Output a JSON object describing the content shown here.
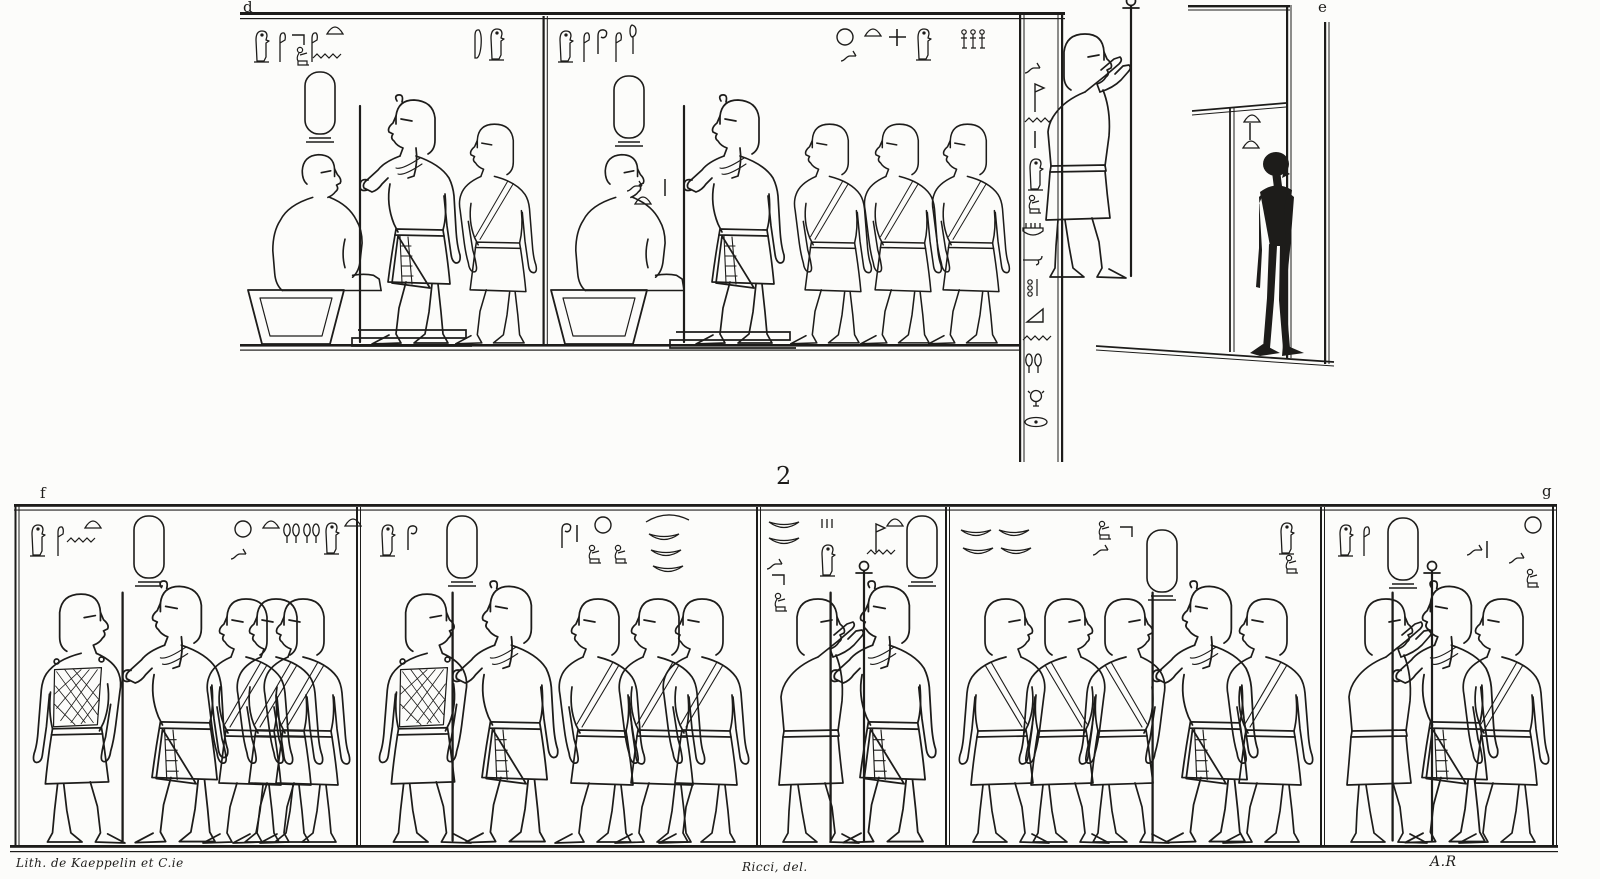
{
  "labels": {
    "top_left": "d",
    "top_right": "e",
    "register_number": "2",
    "bottom_left": "f",
    "bottom_right": "g"
  },
  "credits": {
    "lithographer": "Lith. de Kaeppelin et C.ie",
    "draughtsman": "Ricci, del.",
    "initials": "A.R"
  },
  "colors": {
    "ink": "#1d1c1a",
    "paper": "#fcfcfa"
  },
  "register1": {
    "figures": [
      {
        "t": "seated",
        "x": 250,
        "y": 148,
        "s": 0.95
      },
      {
        "t": "stool",
        "x": 246,
        "y": 288,
        "s": 1
      },
      {
        "t": "king",
        "x": 468,
        "y": 92,
        "s": 1.0,
        "fx": -1
      },
      {
        "t": "attendant",
        "x": 543,
        "y": 117,
        "s": 0.9,
        "fx": -1
      },
      {
        "t": "seated",
        "x": 553,
        "y": 148,
        "s": 0.95
      },
      {
        "t": "stool",
        "x": 549,
        "y": 288,
        "s": 1
      },
      {
        "t": "king",
        "x": 792,
        "y": 92,
        "s": 1.0,
        "fx": -1
      },
      {
        "t": "attendant",
        "x": 878,
        "y": 117,
        "s": 0.9,
        "fx": -1
      },
      {
        "t": "attendant",
        "x": 948,
        "y": 117,
        "s": 0.9,
        "fx": -1
      },
      {
        "t": "attendant",
        "x": 1016,
        "y": 117,
        "s": 0.9,
        "fx": -1
      },
      {
        "t": "silhouette",
        "x": 1240,
        "y": 150,
        "s": 1.0
      }
    ],
    "glyphs": [
      {
        "t": "owl",
        "x": 252,
        "y": 28
      },
      {
        "t": "reed",
        "x": 276,
        "y": 30
      },
      {
        "t": "elbow",
        "x": 290,
        "y": 32
      },
      {
        "t": "reed",
        "x": 308,
        "y": 30
      },
      {
        "t": "loaf",
        "x": 326,
        "y": 24
      },
      {
        "t": "kneel",
        "x": 294,
        "y": 46
      },
      {
        "t": "water",
        "x": 312,
        "y": 52
      },
      {
        "t": "feather",
        "x": 470,
        "y": 28
      },
      {
        "t": "owl",
        "x": 487,
        "y": 26
      },
      {
        "t": "cartouche",
        "x": 303,
        "y": 70
      },
      {
        "t": "owl",
        "x": 556,
        "y": 28
      },
      {
        "t": "reed",
        "x": 580,
        "y": 30
      },
      {
        "t": "crook",
        "x": 594,
        "y": 28
      },
      {
        "t": "reed",
        "x": 612,
        "y": 30
      },
      {
        "t": "mace",
        "x": 626,
        "y": 24
      },
      {
        "t": "sun",
        "x": 836,
        "y": 28
      },
      {
        "t": "loaf",
        "x": 864,
        "y": 26
      },
      {
        "t": "snake",
        "x": 840,
        "y": 48
      },
      {
        "t": "cross",
        "x": 888,
        "y": 28
      },
      {
        "t": "owl",
        "x": 914,
        "y": 26
      },
      {
        "t": "men3",
        "x": 960,
        "y": 28
      },
      {
        "t": "cartouche",
        "x": 612,
        "y": 74
      },
      {
        "t": "snake",
        "x": 626,
        "y": 178
      },
      {
        "t": "loaf",
        "x": 634,
        "y": 194
      },
      {
        "t": "stroke",
        "x": 662,
        "y": 178
      },
      {
        "t": "loaf",
        "x": 1243,
        "y": 112
      },
      {
        "t": "stroke",
        "x": 1247,
        "y": 122
      },
      {
        "t": "loaf",
        "x": 1242,
        "y": 138
      },
      {
        "t": "standard",
        "x": 1031,
        "y": 26
      },
      {
        "t": "snake",
        "x": 1024,
        "y": 60
      },
      {
        "t": "flag",
        "x": 1031,
        "y": 80
      },
      {
        "t": "water",
        "x": 1024,
        "y": 116
      },
      {
        "t": "stroke",
        "x": 1032,
        "y": 130
      },
      {
        "t": "owl",
        "x": 1026,
        "y": 156
      },
      {
        "t": "kneel",
        "x": 1026,
        "y": 194
      },
      {
        "t": "basket",
        "x": 1022,
        "y": 222
      },
      {
        "t": "armcurl",
        "x": 1022,
        "y": 252
      },
      {
        "t": "jardots",
        "x": 1026,
        "y": 278
      },
      {
        "t": "triangle",
        "x": 1026,
        "y": 308
      },
      {
        "t": "water",
        "x": 1022,
        "y": 334
      },
      {
        "t": "looppair",
        "x": 1024,
        "y": 352
      },
      {
        "t": "face",
        "x": 1028,
        "y": 388
      },
      {
        "t": "bowlov",
        "x": 1024,
        "y": 416
      }
    ]
  },
  "register2": {
    "figures": [
      {
        "t": "netted",
        "x": 26,
        "y": 586,
        "s": 1.02
      },
      {
        "t": "king",
        "x": 236,
        "y": 578,
        "s": 1.05,
        "fx": -1
      },
      {
        "t": "attendant",
        "x": 300,
        "y": 591,
        "s": 1.0,
        "fx": -1
      },
      {
        "t": "attendant",
        "x": 330,
        "y": 591,
        "s": 1.0,
        "fx": -1
      },
      {
        "t": "attendant",
        "x": 357,
        "y": 591,
        "s": 1.0,
        "fx": -1
      },
      {
        "t": "netted",
        "x": 372,
        "y": 586,
        "s": 1.02
      },
      {
        "t": "king",
        "x": 566,
        "y": 578,
        "s": 1.05,
        "fx": -1
      },
      {
        "t": "attendant",
        "x": 652,
        "y": 591,
        "s": 1.0,
        "fx": -1
      },
      {
        "t": "attendant",
        "x": 712,
        "y": 591,
        "s": 1.0,
        "fx": -1
      },
      {
        "t": "attendant",
        "x": 756,
        "y": 591,
        "s": 1.0,
        "fx": -1
      },
      {
        "t": "standard",
        "x": 764,
        "y": 591,
        "s": 1.0
      },
      {
        "t": "king",
        "x": 944,
        "y": 578,
        "s": 1.05,
        "fx": -1
      },
      {
        "t": "attendant",
        "x": 952,
        "y": 591,
        "s": 1.0
      },
      {
        "t": "attendant",
        "x": 1012,
        "y": 591,
        "s": 1.0
      },
      {
        "t": "attendant",
        "x": 1072,
        "y": 591,
        "s": 1.0
      },
      {
        "t": "king",
        "x": 1266,
        "y": 578,
        "s": 1.05,
        "fx": -1
      },
      {
        "t": "attendant",
        "x": 1320,
        "y": 591,
        "s": 1.0,
        "fx": -1
      },
      {
        "t": "standard",
        "x": 1332,
        "y": 591,
        "s": 1.0
      },
      {
        "t": "king",
        "x": 1506,
        "y": 578,
        "s": 1.05,
        "fx": -1
      },
      {
        "t": "attendant",
        "x": 1556,
        "y": 591,
        "s": 1.0,
        "fx": -1
      }
    ],
    "glyphs": [
      {
        "t": "owl",
        "x": 28,
        "y": 522
      },
      {
        "t": "reed",
        "x": 54,
        "y": 524
      },
      {
        "t": "water",
        "x": 66,
        "y": 536
      },
      {
        "t": "loaf",
        "x": 84,
        "y": 518
      },
      {
        "t": "cartouche",
        "x": 132,
        "y": 514
      },
      {
        "t": "sun",
        "x": 234,
        "y": 520
      },
      {
        "t": "loaf",
        "x": 262,
        "y": 518
      },
      {
        "t": "snake",
        "x": 230,
        "y": 546
      },
      {
        "t": "looppair",
        "x": 282,
        "y": 522
      },
      {
        "t": "looppair",
        "x": 302,
        "y": 522
      },
      {
        "t": "owl",
        "x": 322,
        "y": 520
      },
      {
        "t": "loaf",
        "x": 344,
        "y": 516
      },
      {
        "t": "owl",
        "x": 378,
        "y": 522
      },
      {
        "t": "crook",
        "x": 404,
        "y": 524
      },
      {
        "t": "cartouche",
        "x": 445,
        "y": 514
      },
      {
        "t": "crook",
        "x": 558,
        "y": 522
      },
      {
        "t": "stroke",
        "x": 574,
        "y": 524
      },
      {
        "t": "sun",
        "x": 594,
        "y": 516
      },
      {
        "t": "kneel",
        "x": 586,
        "y": 544
      },
      {
        "t": "kneel",
        "x": 612,
        "y": 544
      },
      {
        "t": "wavebowl",
        "x": 645,
        "y": 514
      },
      {
        "t": "crescent",
        "x": 648,
        "y": 532
      },
      {
        "t": "crescent",
        "x": 650,
        "y": 548
      },
      {
        "t": "crescent",
        "x": 652,
        "y": 564
      },
      {
        "t": "crescent",
        "x": 768,
        "y": 520
      },
      {
        "t": "crescent",
        "x": 768,
        "y": 536
      },
      {
        "t": "snake",
        "x": 766,
        "y": 556
      },
      {
        "t": "elbow",
        "x": 770,
        "y": 572
      },
      {
        "t": "kneel",
        "x": 772,
        "y": 592
      },
      {
        "t": "ticks",
        "x": 820,
        "y": 518
      },
      {
        "t": "owl",
        "x": 818,
        "y": 542
      },
      {
        "t": "flag",
        "x": 872,
        "y": 520
      },
      {
        "t": "loaf",
        "x": 886,
        "y": 516
      },
      {
        "t": "water",
        "x": 866,
        "y": 548
      },
      {
        "t": "cartouche",
        "x": 905,
        "y": 514
      },
      {
        "t": "crescent",
        "x": 960,
        "y": 528
      },
      {
        "t": "crescent",
        "x": 998,
        "y": 528
      },
      {
        "t": "crescent",
        "x": 962,
        "y": 546
      },
      {
        "t": "crescent",
        "x": 1000,
        "y": 546
      },
      {
        "t": "kneel",
        "x": 1096,
        "y": 520
      },
      {
        "t": "snake",
        "x": 1092,
        "y": 542
      },
      {
        "t": "elbow",
        "x": 1118,
        "y": 524
      },
      {
        "t": "cartouche",
        "x": 1145,
        "y": 528
      },
      {
        "t": "owl",
        "x": 1277,
        "y": 520
      },
      {
        "t": "kneel",
        "x": 1283,
        "y": 554
      },
      {
        "t": "owl",
        "x": 1336,
        "y": 522
      },
      {
        "t": "reed",
        "x": 1360,
        "y": 524
      },
      {
        "t": "cartouche",
        "x": 1386,
        "y": 516
      },
      {
        "t": "snake",
        "x": 1466,
        "y": 542
      },
      {
        "t": "stroke",
        "x": 1484,
        "y": 540
      },
      {
        "t": "sun",
        "x": 1524,
        "y": 516
      },
      {
        "t": "snake",
        "x": 1508,
        "y": 550
      },
      {
        "t": "kneel",
        "x": 1524,
        "y": 568
      }
    ]
  }
}
